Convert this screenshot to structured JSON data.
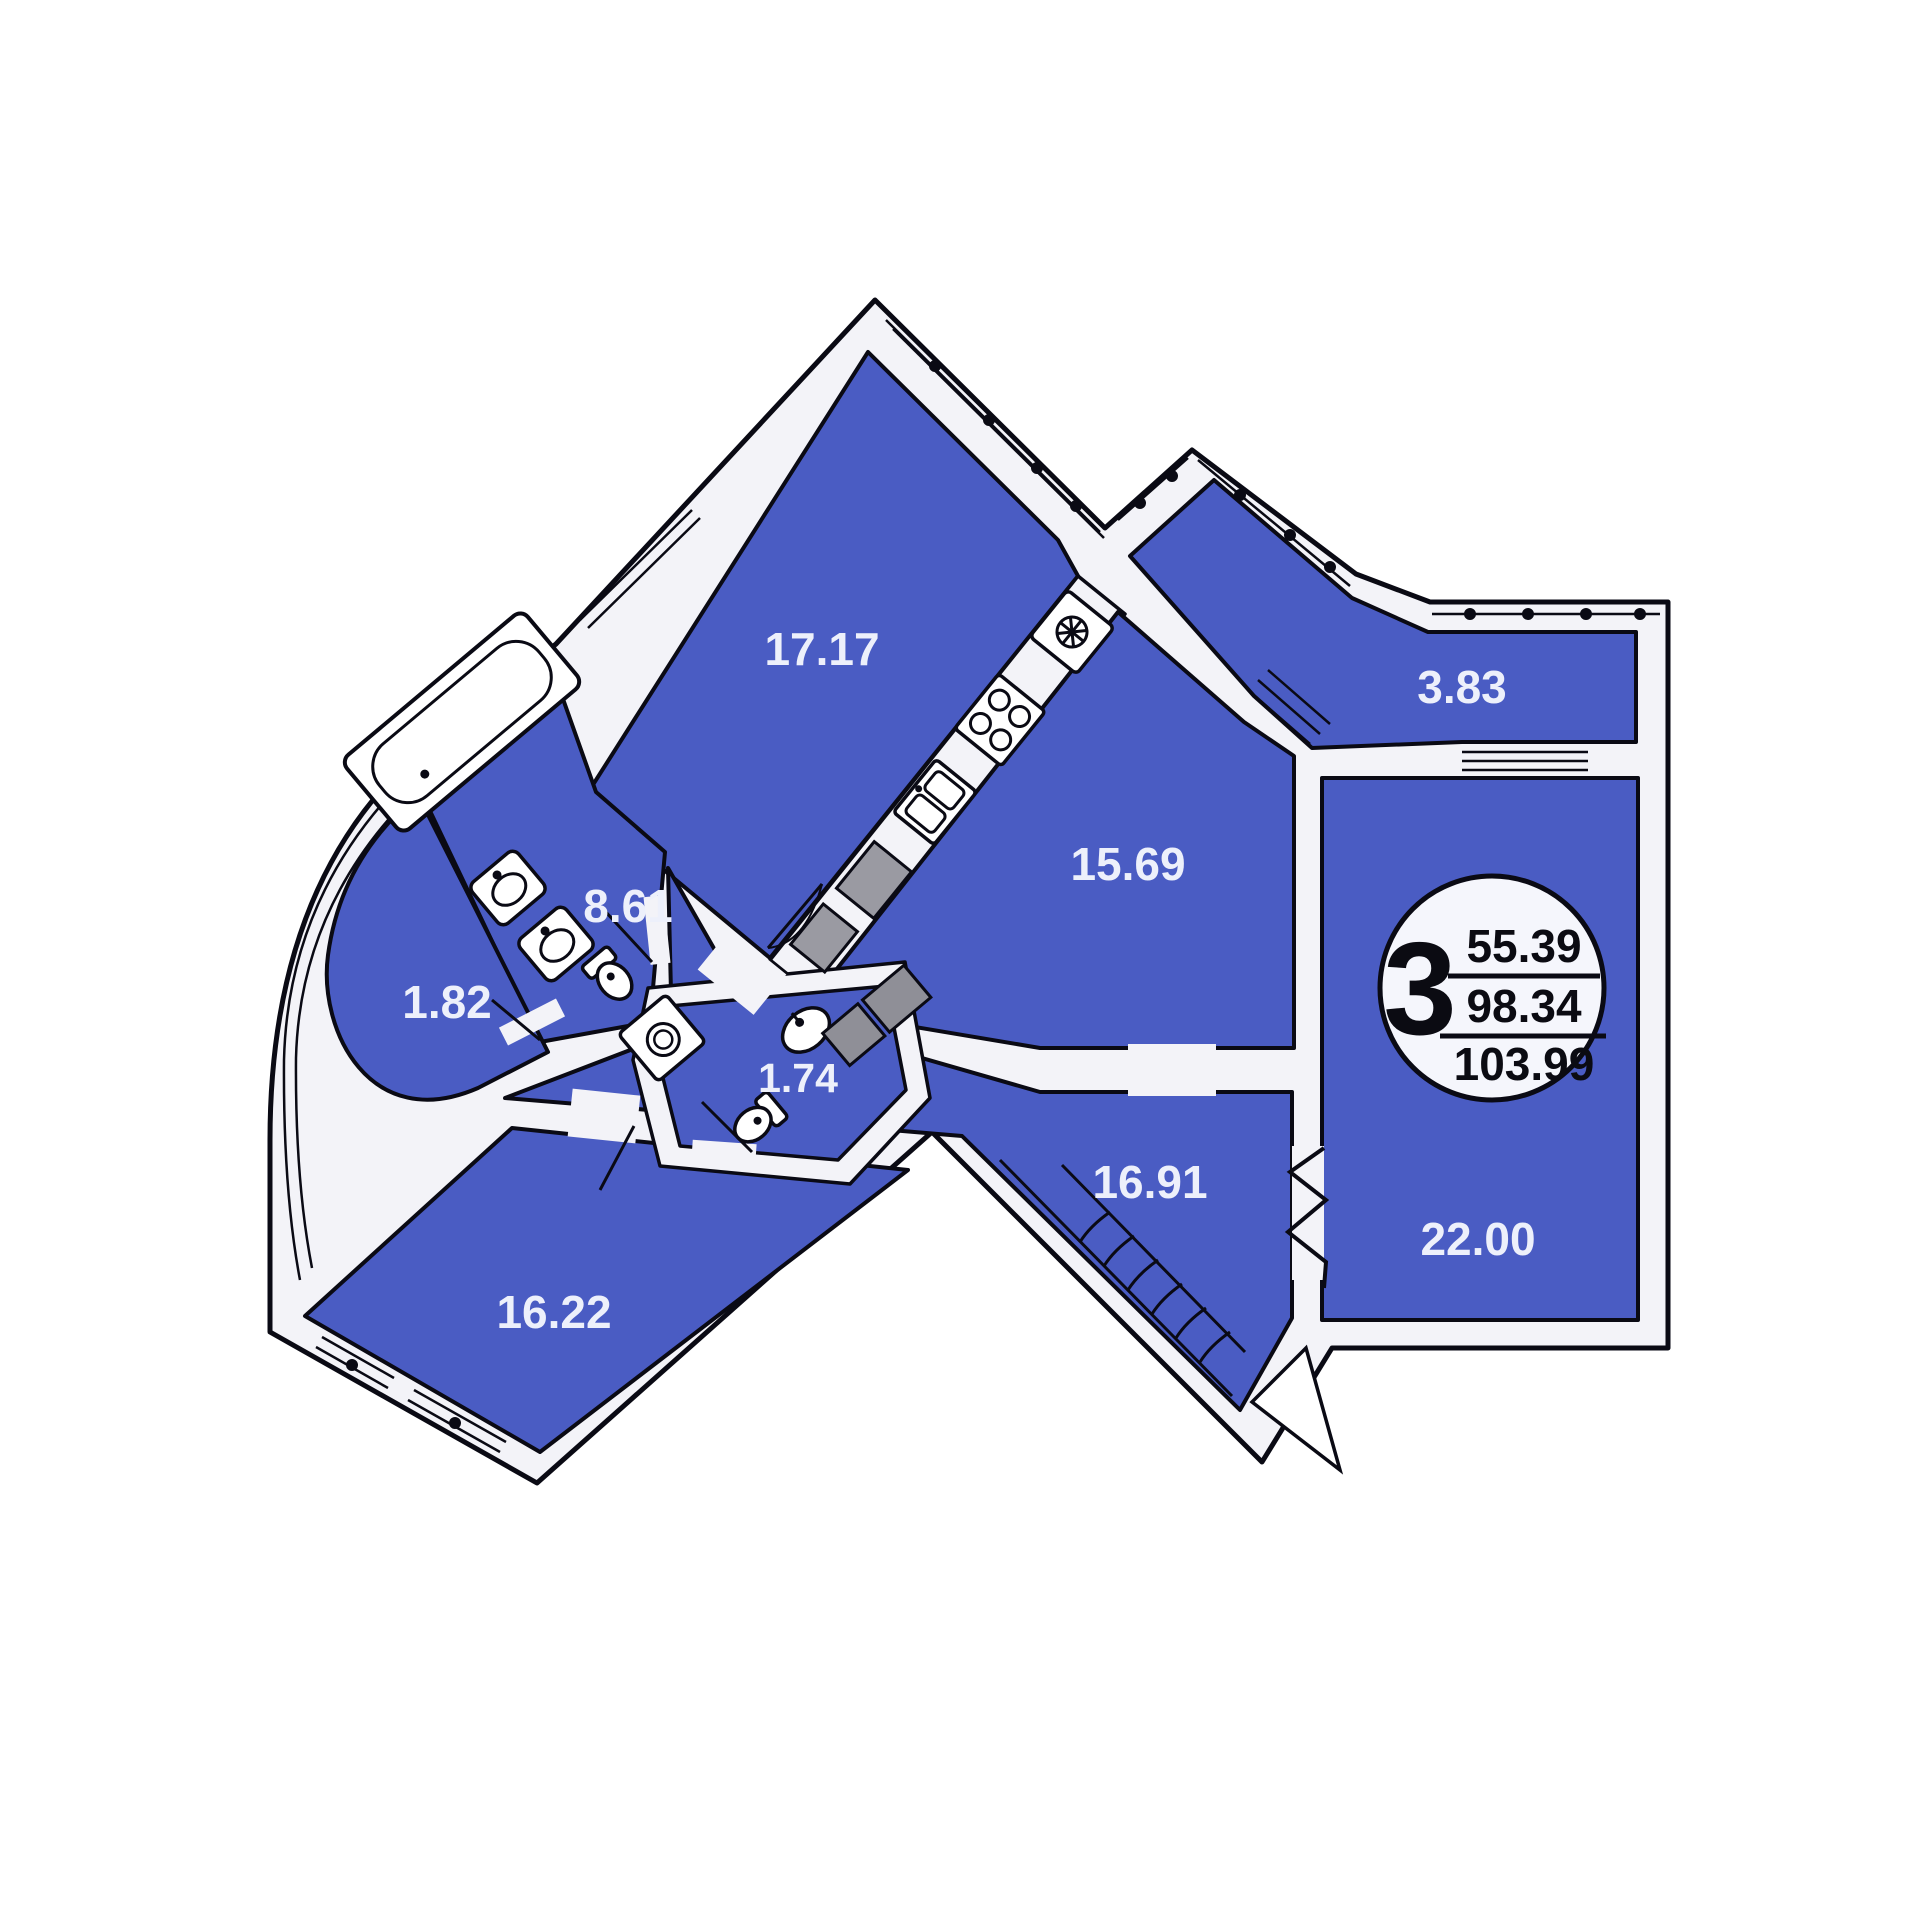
{
  "plan": {
    "type": "apartment-floor-plan",
    "rooms": [
      {
        "id": "living-room",
        "area": "17.17"
      },
      {
        "id": "bathroom",
        "area": "8.61"
      },
      {
        "id": "balcony-left",
        "area": "1.82"
      },
      {
        "id": "wc",
        "area": "1.74"
      },
      {
        "id": "kitchen",
        "area": "15.69"
      },
      {
        "id": "balcony-top",
        "area": "3.83"
      },
      {
        "id": "hallway",
        "area": "16.91"
      },
      {
        "id": "bedroom-bottom",
        "area": "16.22"
      },
      {
        "id": "bedroom-right",
        "area": "22.00"
      }
    ],
    "badge": {
      "rooms_count": "3",
      "living_area": "55.39",
      "middle_area": "98.34",
      "total_area": "103.99"
    },
    "colors": {
      "room_fill": "#4a5cc3",
      "outline": "#0a0a14",
      "wall_fill": "#f3f3f8",
      "label_text": "#edf0fb",
      "badge_bg": "#f5f6fc",
      "badge_text": "#0b0b12",
      "fixture_gray": "#8f8f97"
    }
  }
}
